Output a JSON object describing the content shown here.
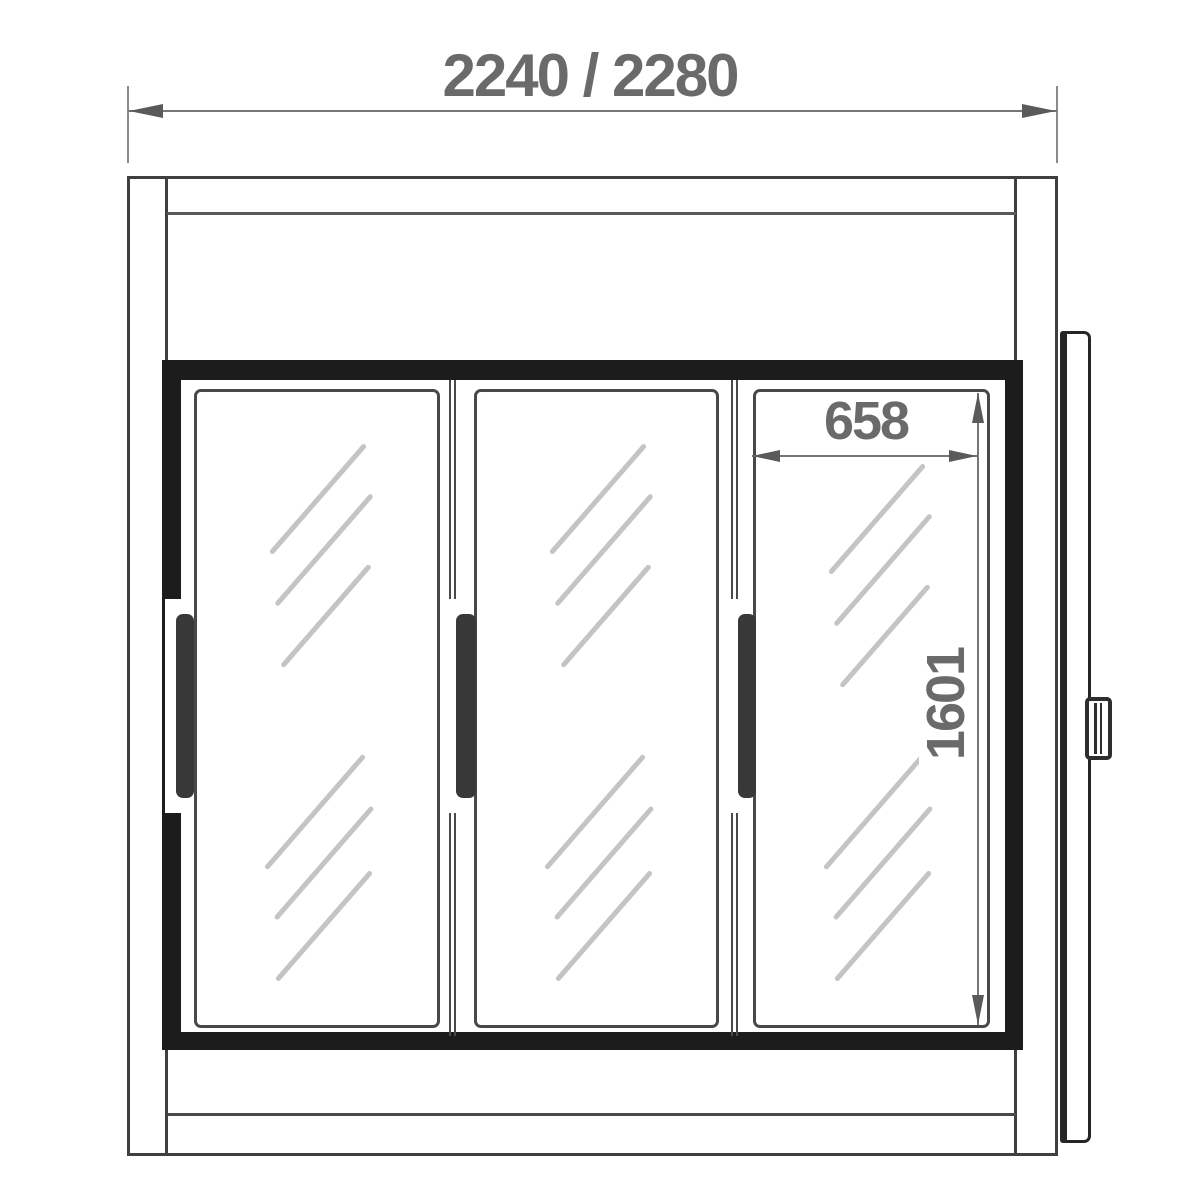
{
  "dimensions": {
    "overall_width_label": "2240 / 2280",
    "door_width_label": "658",
    "door_height_label": "1601"
  },
  "colors": {
    "background": "#ffffff",
    "outline_dark": "#3f3f3f",
    "frame_black": "#1c1c1c",
    "dimension_gray": "#6a6a6a",
    "dimension_line": "#767676",
    "hatch_gray": "#c4c4c4",
    "handle_dark": "#383838"
  }
}
